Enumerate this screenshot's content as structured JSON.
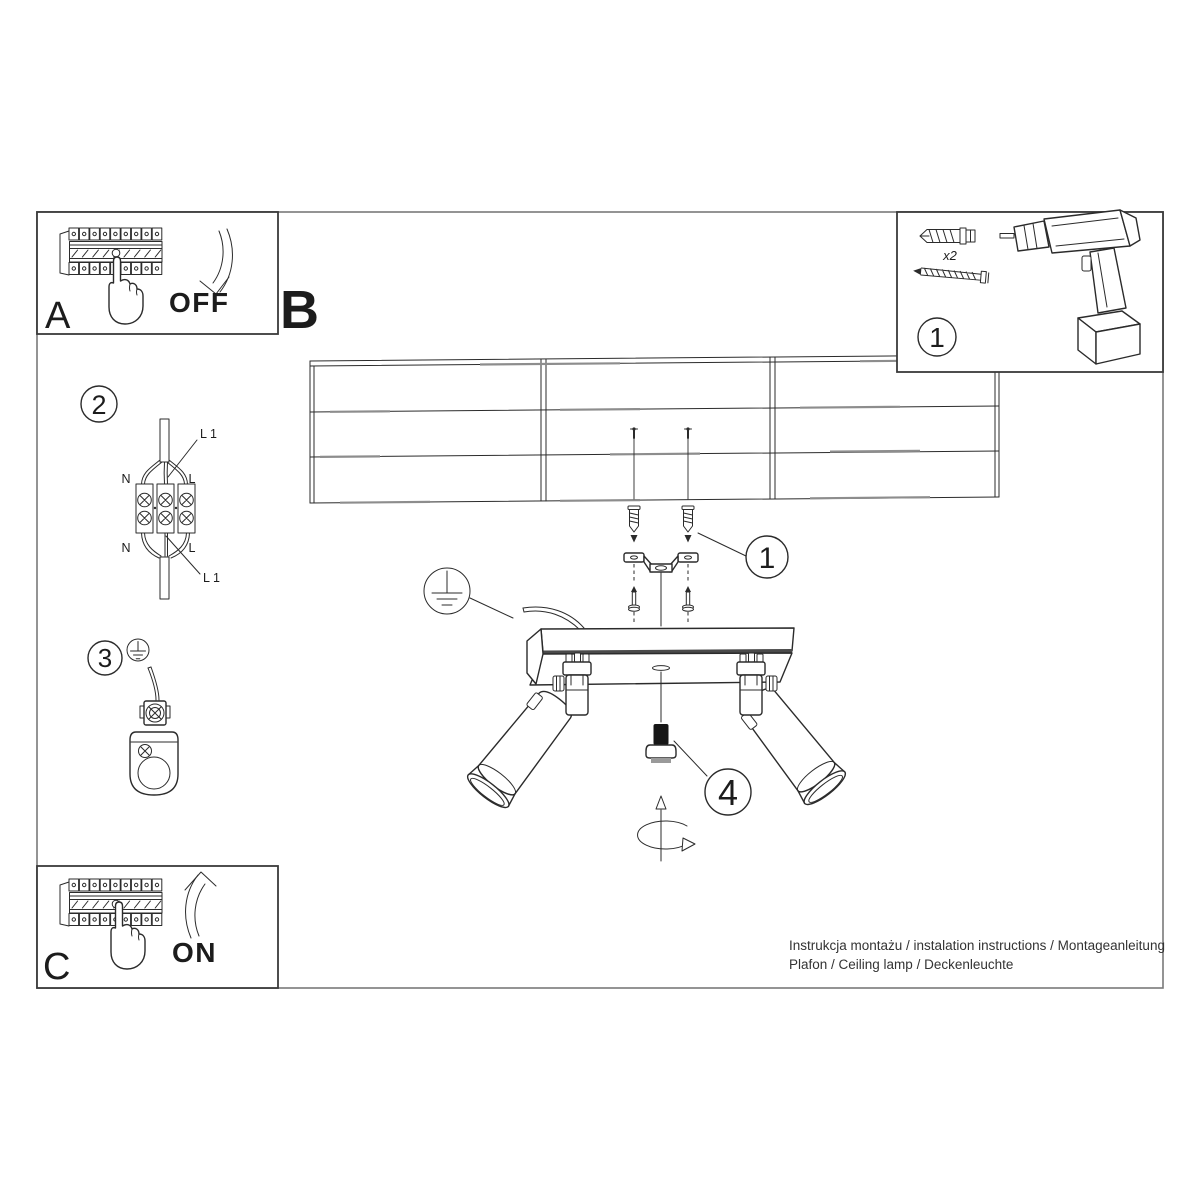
{
  "sheet": {
    "colors": {
      "background": "#ffffff",
      "ink": "#2b2b2b",
      "gray_wood": "#8d8d8d",
      "border": "#7a7a7a"
    }
  },
  "panel_a": {
    "label": "A",
    "state": "OFF"
  },
  "section_b": {
    "label": "B"
  },
  "panel_c": {
    "label": "C",
    "state": "ON"
  },
  "kit_box": {
    "badge": "1",
    "anchor_qty": "x2"
  },
  "step_wiring": {
    "badge": "2",
    "labels": {
      "l1_top": "L 1",
      "n_top": "N",
      "l_top": "L",
      "n_bottom": "N",
      "l_bottom": "L",
      "l1_bottom": "L 1"
    }
  },
  "step_ground": {
    "badge": "3"
  },
  "step_bracket": {
    "badge": "1"
  },
  "step_knob": {
    "badge": "4"
  },
  "footer": {
    "line1": "Instrukcja montażu / instalation instructions / Montageanleitung",
    "line2": "Plafon / Ceiling lamp / Deckenleuchte"
  }
}
